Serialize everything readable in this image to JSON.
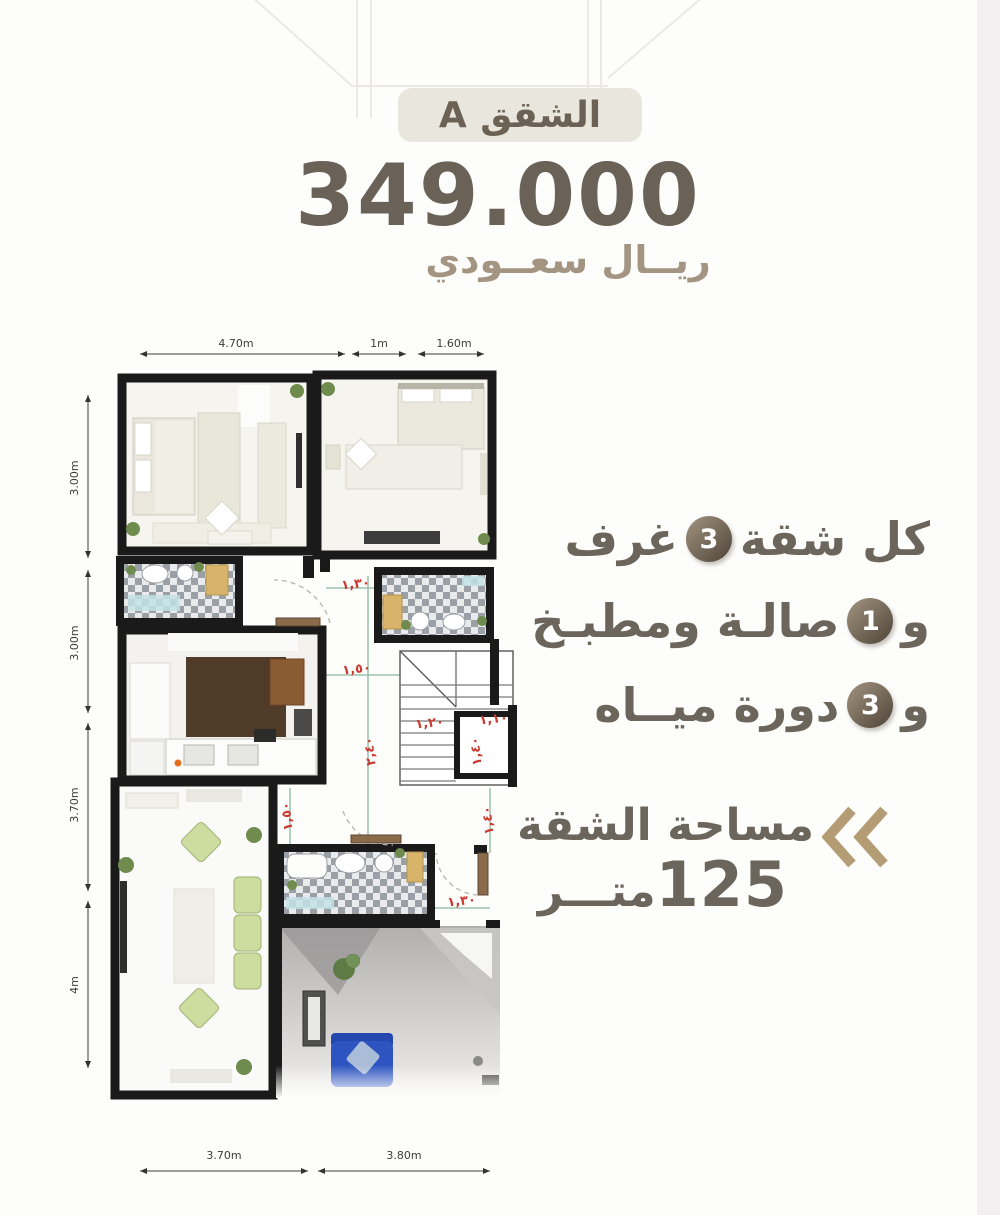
{
  "header": {
    "badge_label": "الشقق A",
    "price": "349.000",
    "currency": "ريــال سعــودي"
  },
  "features": {
    "items": [
      {
        "prefix": "كل شقة",
        "count": "3",
        "suffix": "غرف"
      },
      {
        "prefix": "و",
        "count": "1",
        "suffix": "صالـة ومطبـخ"
      },
      {
        "prefix": "و",
        "count": "3",
        "suffix": "دورة ميــاه"
      }
    ]
  },
  "area": {
    "label": "مساحة الشقة",
    "value": "125",
    "unit": "متـــر"
  },
  "floorplan": {
    "dims_top": [
      "4.70m",
      "1m",
      "1.60m"
    ],
    "dims_left": [
      "3.00m",
      "3.00m",
      "3.70m",
      "4m"
    ],
    "dims_bottom": [
      "3.70m",
      "3.80m"
    ],
    "red_dims": [
      "١,٣٠",
      "١,٥٠",
      "٢,٤٠",
      "١,٢٠",
      "١,١٠",
      "١,٤٠",
      "١,٥٠",
      "١,٤٠",
      "١,٣٠"
    ]
  },
  "colors": {
    "accent_gold": "#b49d74",
    "text_brown": "#6b655b",
    "price_color": "#6a6257",
    "badge_bg": "#e9e6dd",
    "red_dim": "#c93a31",
    "wall": "#1a1a1a",
    "sofa_green": "#ccdd9f",
    "kitchen_wood": "#503a28",
    "tile_gray": "#9aa0a6",
    "blue_sofa": "#2d54c0"
  }
}
